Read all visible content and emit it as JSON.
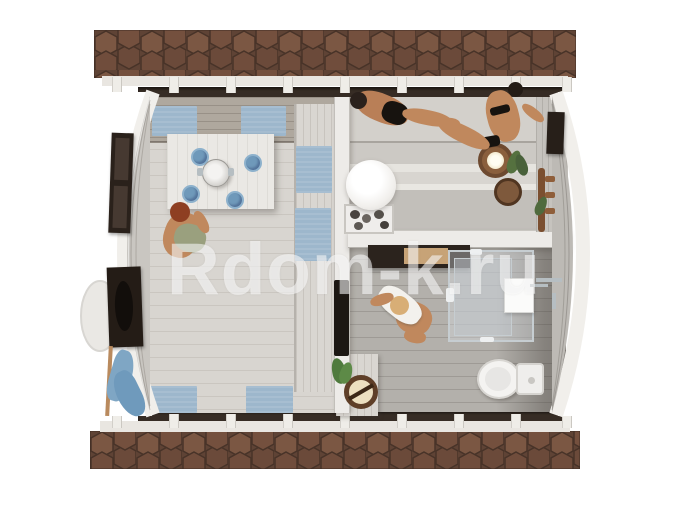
{
  "watermark": {
    "text": "Rdom-k.ru"
  },
  "palette": {
    "background": "#ffffff",
    "roof_shingle_base": "#5f4335",
    "roof_shingle_light": "#7b5743",
    "roof_shingle_mid": "#6b4a3a",
    "wall_edge_dark": "#362c25",
    "fascia_white": "#e9e6e1",
    "floor_lounge": "#d8d5d0",
    "floor_bathroom": "#b3b0ab",
    "bench_wood": "#d9d6d1",
    "partition_white": "#edebe8",
    "textile_blue": "#9db7cc",
    "frame_dark_brown": "#2a211b",
    "skin_tone": "#c0885d",
    "towel_white": "#f3f1ed",
    "bucket_wood": "#6e4a30",
    "plant_green": "#55713f",
    "lamp_white": "#ffffff"
  }
}
